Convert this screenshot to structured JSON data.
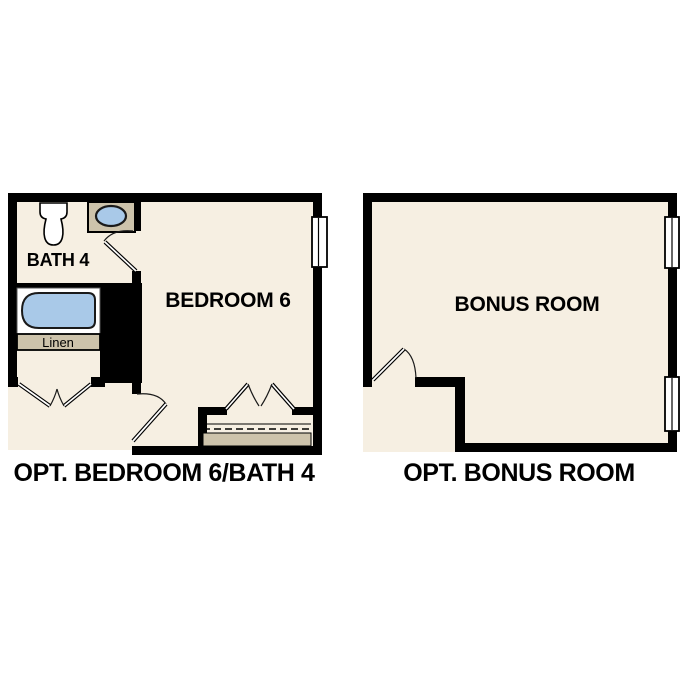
{
  "colors": {
    "background": "#ffffff",
    "floor": "#f6efe2",
    "wall": "#000000",
    "fixture_tan": "#cdc3ab",
    "water_blue": "#a9c9e8",
    "text": "#000000"
  },
  "plans": [
    {
      "caption": "OPT. BEDROOM 6/BATH 4",
      "rooms": [
        {
          "label": "BATH 4"
        },
        {
          "label": "BEDROOM 6"
        }
      ],
      "closet_label": "Linen",
      "fixtures": [
        {
          "name": "toilet-icon"
        },
        {
          "name": "vanity-sink-icon"
        },
        {
          "name": "bathtub-icon"
        },
        {
          "name": "linen-closet"
        },
        {
          "name": "double-doors"
        },
        {
          "name": "bifold-closet-doors"
        },
        {
          "name": "swing-door"
        },
        {
          "name": "window"
        }
      ]
    },
    {
      "caption": "OPT. BONUS ROOM",
      "rooms": [
        {
          "label": "BONUS ROOM"
        }
      ],
      "fixtures": [
        {
          "name": "swing-door"
        },
        {
          "name": "window"
        },
        {
          "name": "window"
        }
      ]
    }
  ]
}
